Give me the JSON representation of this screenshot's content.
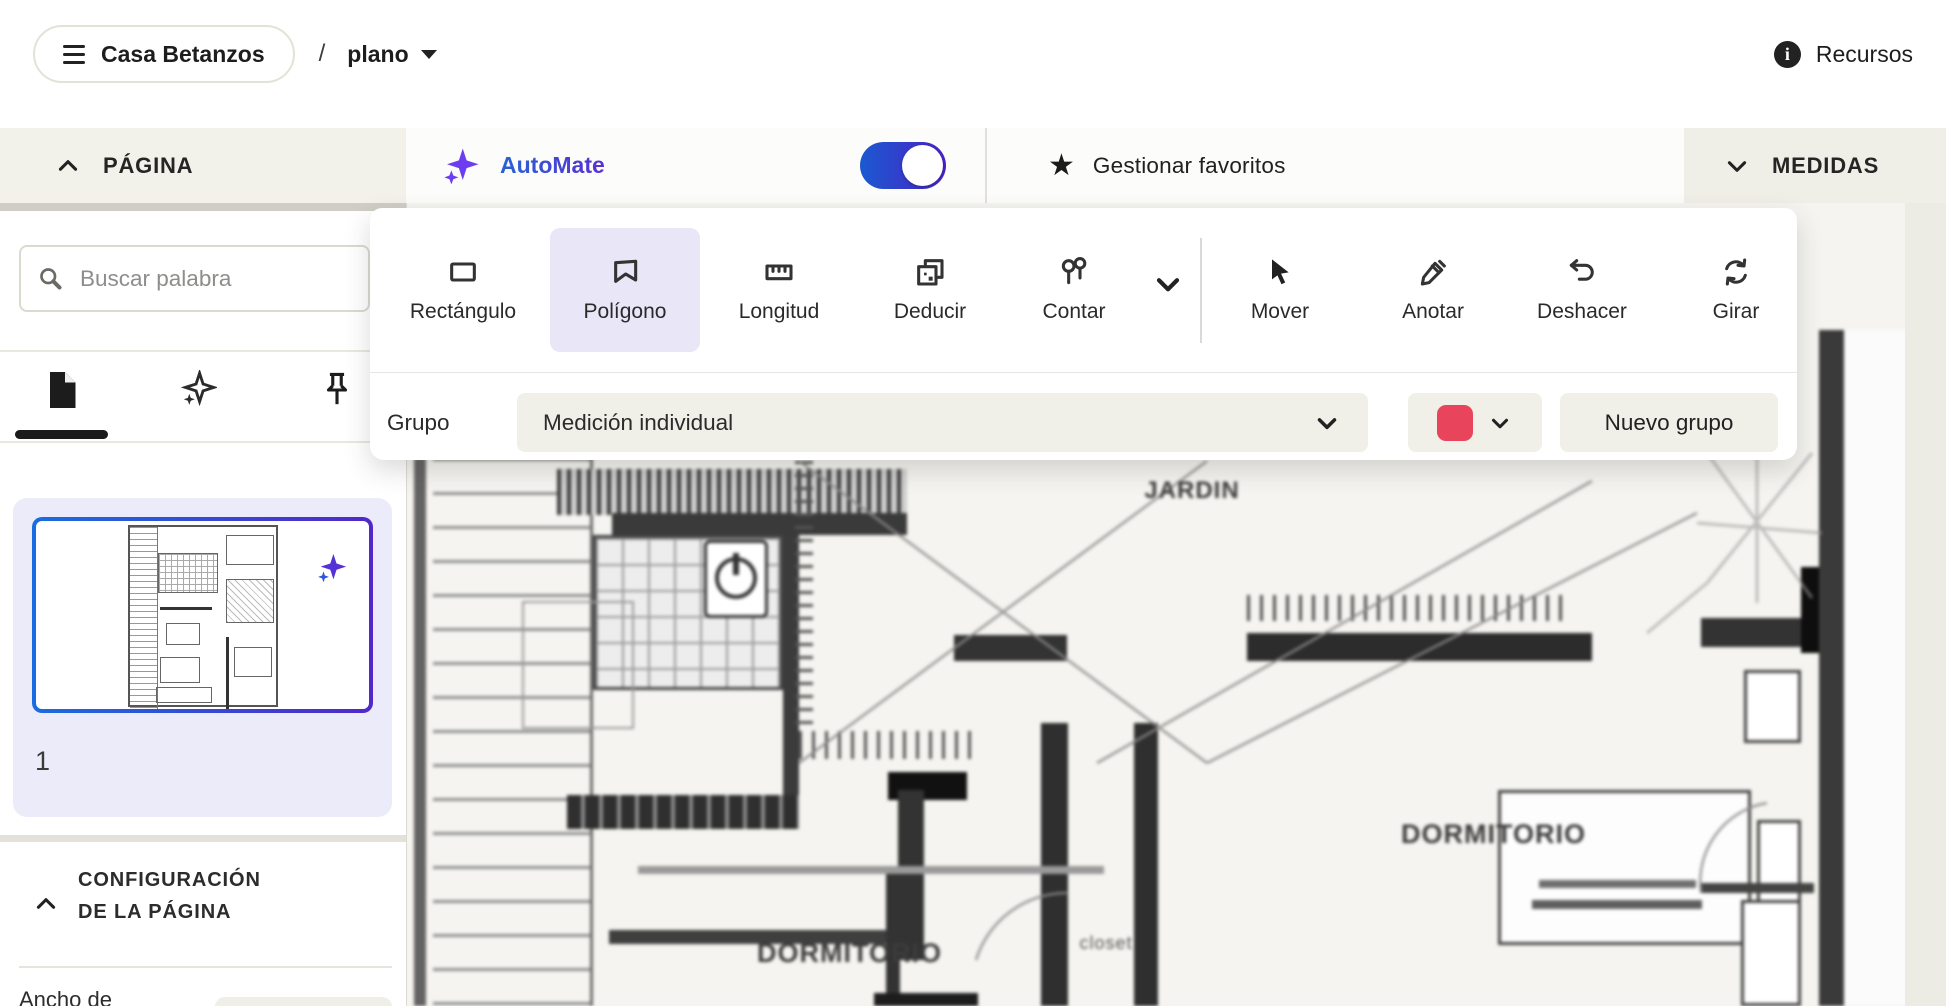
{
  "topbar": {
    "project_name": "Casa Betanzos",
    "separator": "/",
    "page_select": "plano",
    "resources": "Recursos"
  },
  "bars": {
    "page_panel": "PÁGINA",
    "automate": "AutoMate",
    "automate_enabled": true,
    "favorites": "Gestionar favoritos",
    "measures": "MEDIDAS"
  },
  "toolbar": {
    "selected_tool": "Polígono",
    "tools": [
      {
        "label": "Rectángulo"
      },
      {
        "label": "Polígono"
      },
      {
        "label": "Longitud"
      },
      {
        "label": "Deducir"
      },
      {
        "label": "Contar"
      },
      {
        "label": "Mover"
      },
      {
        "label": "Anotar"
      },
      {
        "label": "Deshacer"
      },
      {
        "label": "Girar"
      }
    ]
  },
  "group_row": {
    "label": "Grupo",
    "selected_group": "Medición individual",
    "new_group_button": "Nuevo grupo",
    "group_color": "#E8445C"
  },
  "sidebar": {
    "search_placeholder": "Buscar palabra",
    "page_thumbnail_number": "1",
    "config_line1": "CONFIGURACIÓN",
    "config_line2": "DE LA PÁGINA",
    "width_field_label": "Ancho de"
  },
  "plan": {
    "labels": {
      "garden": "JARDIN",
      "bedroom_right": "DORMITORIO",
      "bedroom_bottom": "DORMITORIO",
      "closet": "closet"
    }
  },
  "colors": {
    "accent_blue": "#2563D6",
    "accent_purple": "#5B2FD1",
    "group_color": "#E8445C"
  }
}
